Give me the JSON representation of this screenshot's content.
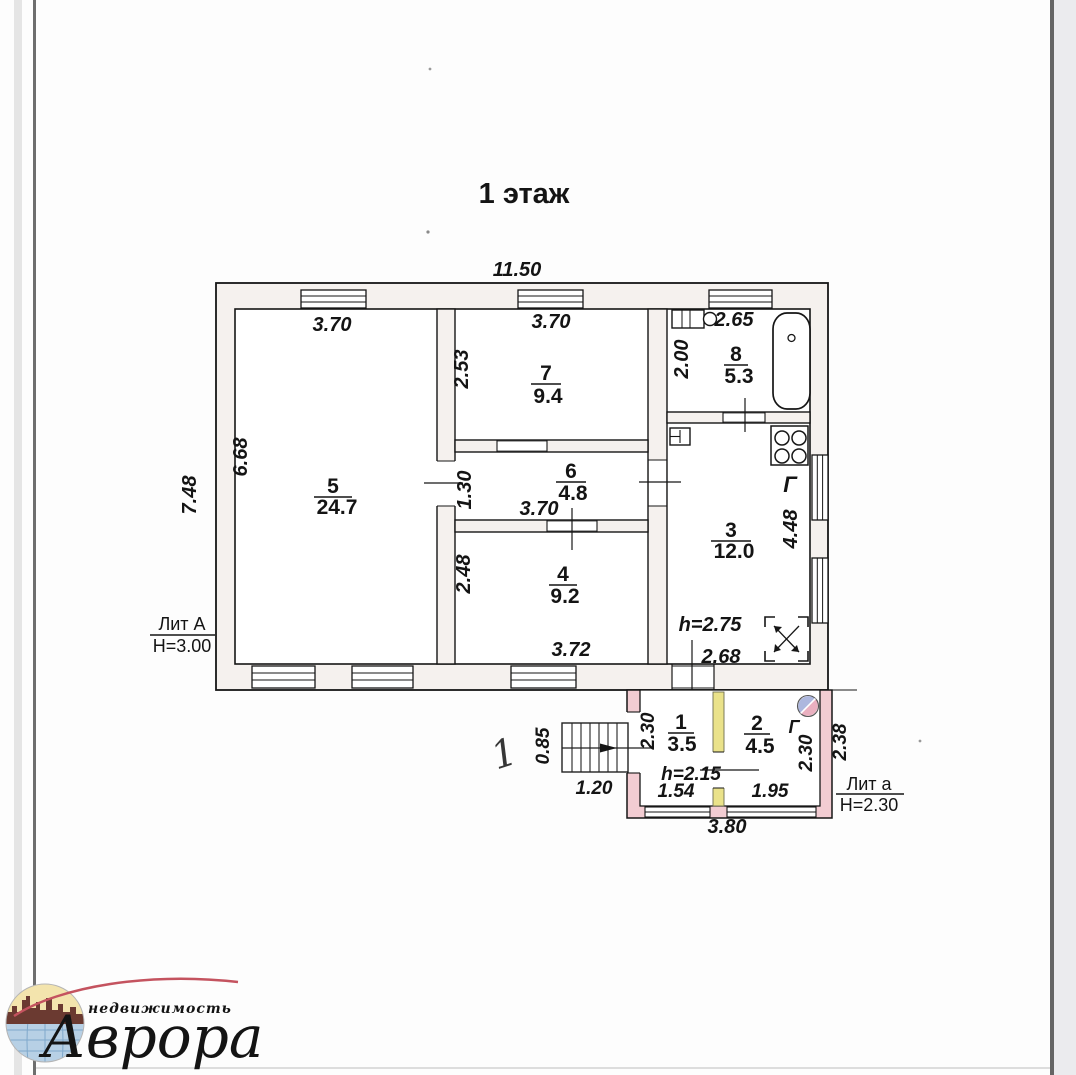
{
  "title": "1 этаж",
  "colors": {
    "wall_fill": "#f5f1ee",
    "annex_wall": "#f2ccd2",
    "partition_yellow": "#eae28a",
    "red_mark": "#c5506c",
    "logo_red": "#c4535f",
    "logo_yellow": "#f3e4ad",
    "logo_blue": "#b7d0e5",
    "logo_skyline": "#6b3a31",
    "stove_circle_blue": "#adb7de",
    "stove_circle_pink": "#eab0c0"
  },
  "building_a": {
    "lit": "Лит А",
    "h": "Н=3.00",
    "w": "11.50",
    "d": "7.48",
    "ceiling": "h=2.75",
    "gas": "Г",
    "kitchen_w": "2.68",
    "room5": {
      "num": "5",
      "area": "24.7",
      "w": "3.70",
      "d": "6.68"
    },
    "room7": {
      "num": "7",
      "area": "9.4",
      "w": "3.70",
      "d": "2.53"
    },
    "room6": {
      "num": "6",
      "area": "4.8",
      "w": "3.70",
      "d": "1.30"
    },
    "room4": {
      "num": "4",
      "area": "9.2",
      "w": "3.72",
      "d": "2.48"
    },
    "room8": {
      "num": "8",
      "area": "5.3",
      "w": "2.65",
      "d": "2.00"
    },
    "room3": {
      "num": "3",
      "area": "12.0",
      "d": "4.48"
    }
  },
  "annex": {
    "lit": "Лит а",
    "h": "Н=2.30",
    "w_total": "3.80",
    "d_right": "2.38",
    "ceiling": "h=2.15",
    "gas": "Г",
    "room1": {
      "num": "1",
      "area": "3.5",
      "w": "1.54",
      "d": "2.30"
    },
    "room2": {
      "num": "2",
      "area": "4.5",
      "w": "1.95",
      "d": "2.30"
    },
    "stairs": {
      "w": "1.20",
      "d": "0.85"
    },
    "red_mark": "1"
  },
  "logo": {
    "tagline": "недвижимость",
    "brand": "Аврора"
  }
}
